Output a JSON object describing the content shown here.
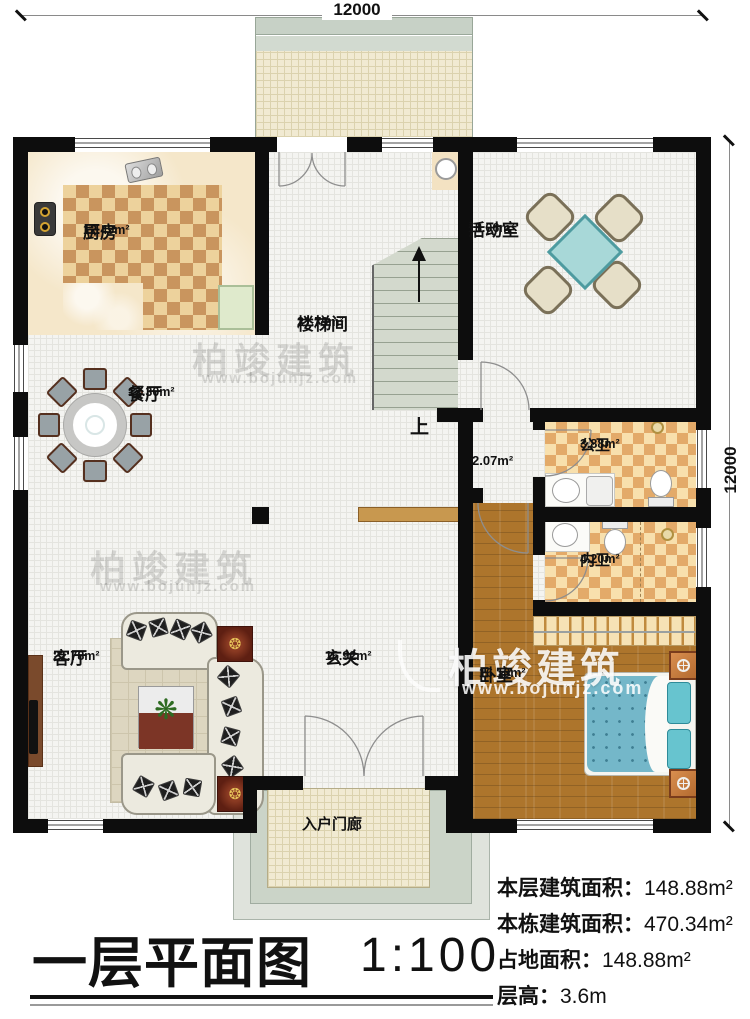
{
  "meta": {
    "title": "一层平面图",
    "scale": "1:100"
  },
  "dimensions": {
    "top": "12000",
    "right": "12000"
  },
  "rooms": [
    {
      "name": "厨房",
      "area": "12.49m²"
    },
    {
      "name": "活动室",
      "area": "18.06m²"
    },
    {
      "name": "楼梯间",
      "area": "21.79m²"
    },
    {
      "name": "餐厅",
      "area": "12.30m²"
    },
    {
      "name": "公卫",
      "area": "3.88m²"
    },
    {
      "name": "内卫",
      "area": "4.20m²"
    },
    {
      "name": "客厅",
      "area": "21.78m²"
    },
    {
      "name": "玄关",
      "area": "16.92m²"
    },
    {
      "name": "卧室",
      "area": "16.10m²"
    },
    {
      "name": "入户门廊",
      "area": ""
    }
  ],
  "annotations": {
    "stair_up": "上",
    "small_area": "2.07m²"
  },
  "watermark": {
    "name": "柏竣建筑",
    "url": "www.bojunjz.com"
  },
  "info": [
    {
      "label": "本层建筑面积：",
      "value": "148.88m²"
    },
    {
      "label": "本栋建筑面积：",
      "value": "470.34m²"
    },
    {
      "label": "占地面积：",
      "value": "148.88m²"
    },
    {
      "label": "层高：",
      "value": "3.6m"
    }
  ],
  "colors": {
    "wall": "#0d0d0d",
    "wood": "#ad752c",
    "table": "#a8d8d8",
    "bed": "#74b7c9",
    "checker_dark": "#c9955e"
  }
}
